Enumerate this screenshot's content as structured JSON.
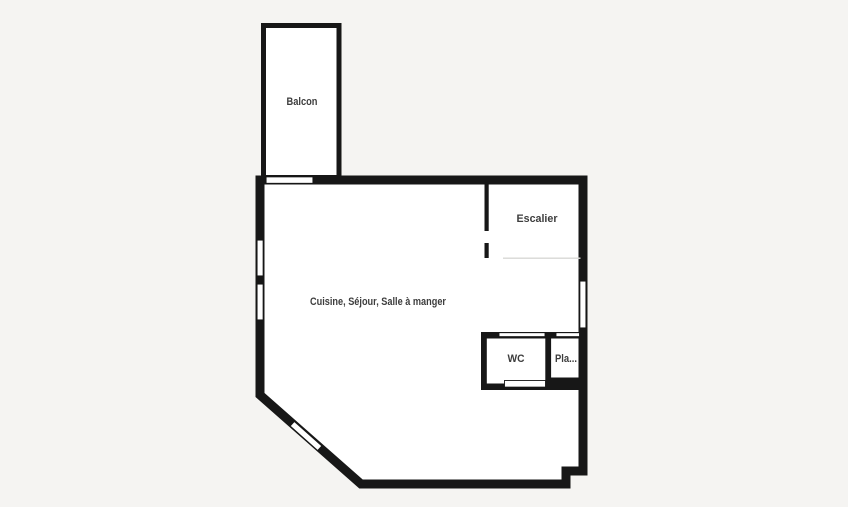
{
  "plan": {
    "type": "apartment-floor-plan",
    "rooms": {
      "balcony": {
        "label": "Balcon"
      },
      "staircase": {
        "label": "Escalier"
      },
      "living": {
        "label": "Cuisine, Séjour, Salle à manger"
      },
      "wc": {
        "label": "WC"
      },
      "closet": {
        "label": "Pla..."
      }
    },
    "features": {
      "windows_count": 5,
      "door_openings_count": 3
    },
    "colors": {
      "background": "#f5f4f2",
      "wall": "#171717",
      "room_fill": "#ffffff",
      "label_text": "#3d3d3d",
      "zone_divider_line": "#d9d9d6"
    }
  }
}
